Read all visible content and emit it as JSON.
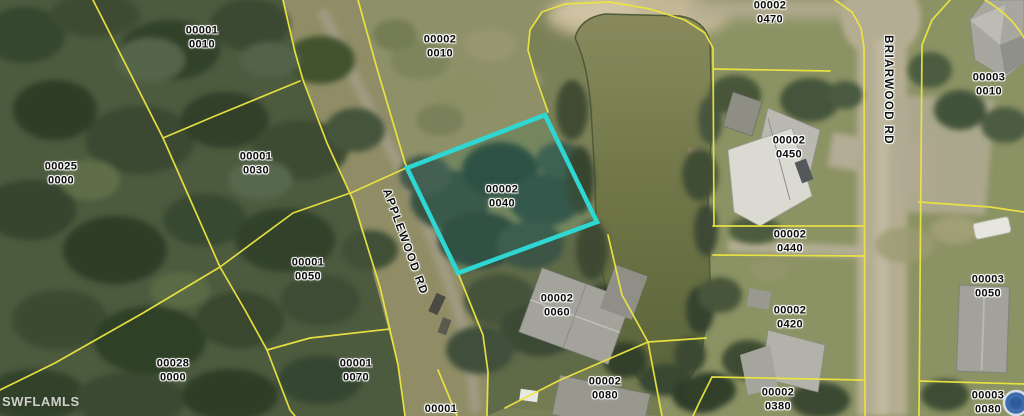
{
  "map": {
    "watermark": "SWFLAMLS",
    "highlighted_parcel": {
      "label": "00002 0040",
      "outline_color": "#2ed7d2"
    },
    "colors": {
      "parcel_line": "#ece542",
      "highlight": "#2ed7d2",
      "water": "#6f754a",
      "road_surface": "#b5ad93",
      "label_text": "#0b0b0b",
      "label_halo": "#ffffff",
      "watermark_color": "#f0f0ee"
    },
    "road_labels": [
      {
        "id": "applewood",
        "name": "APPLEWOOD RD"
      },
      {
        "id": "briarwood",
        "name": "BRIARWOOD RD"
      }
    ],
    "parcel_labels": [
      {
        "line1": "00001",
        "line2": "0010",
        "x": 202,
        "y": 38,
        "highlighted": false
      },
      {
        "line1": "00002",
        "line2": "0010",
        "x": 440,
        "y": 47,
        "highlighted": false
      },
      {
        "line1": "00002",
        "line2": "0470",
        "x": 770,
        "y": 13,
        "highlighted": false
      },
      {
        "line1": "00003",
        "line2": "0010",
        "x": 989,
        "y": 85,
        "highlighted": false
      },
      {
        "line1": "00025",
        "line2": "0000",
        "x": 61,
        "y": 174,
        "highlighted": false
      },
      {
        "line1": "00001",
        "line2": "0030",
        "x": 256,
        "y": 164,
        "highlighted": false
      },
      {
        "line1": "00002",
        "line2": "0450",
        "x": 789,
        "y": 148,
        "highlighted": false
      },
      {
        "line1": "00002",
        "line2": "0040",
        "x": 502,
        "y": 197,
        "highlighted": true
      },
      {
        "line1": "00001",
        "line2": "0050",
        "x": 308,
        "y": 270,
        "highlighted": false
      },
      {
        "line1": "00002",
        "line2": "0440",
        "x": 790,
        "y": 242,
        "highlighted": false
      },
      {
        "line1": "00003",
        "line2": "0050",
        "x": 988,
        "y": 287,
        "highlighted": false
      },
      {
        "line1": "00002",
        "line2": "0420",
        "x": 790,
        "y": 318,
        "highlighted": false
      },
      {
        "line1": "00002",
        "line2": "0060",
        "x": 557,
        "y": 306,
        "highlighted": false
      },
      {
        "line1": "00028",
        "line2": "0000",
        "x": 173,
        "y": 371,
        "highlighted": false
      },
      {
        "line1": "00001",
        "line2": "0070",
        "x": 356,
        "y": 371,
        "highlighted": false
      },
      {
        "line1": "00002",
        "line2": "0080",
        "x": 605,
        "y": 389,
        "highlighted": false
      },
      {
        "line1": "00002",
        "line2": "0380",
        "x": 778,
        "y": 400,
        "highlighted": false
      },
      {
        "line1": "00003",
        "line2": "0080",
        "x": 988,
        "y": 403,
        "highlighted": false
      },
      {
        "line1": "00001",
        "line2": "",
        "x": 441,
        "y": 409,
        "highlighted": false
      }
    ]
  }
}
